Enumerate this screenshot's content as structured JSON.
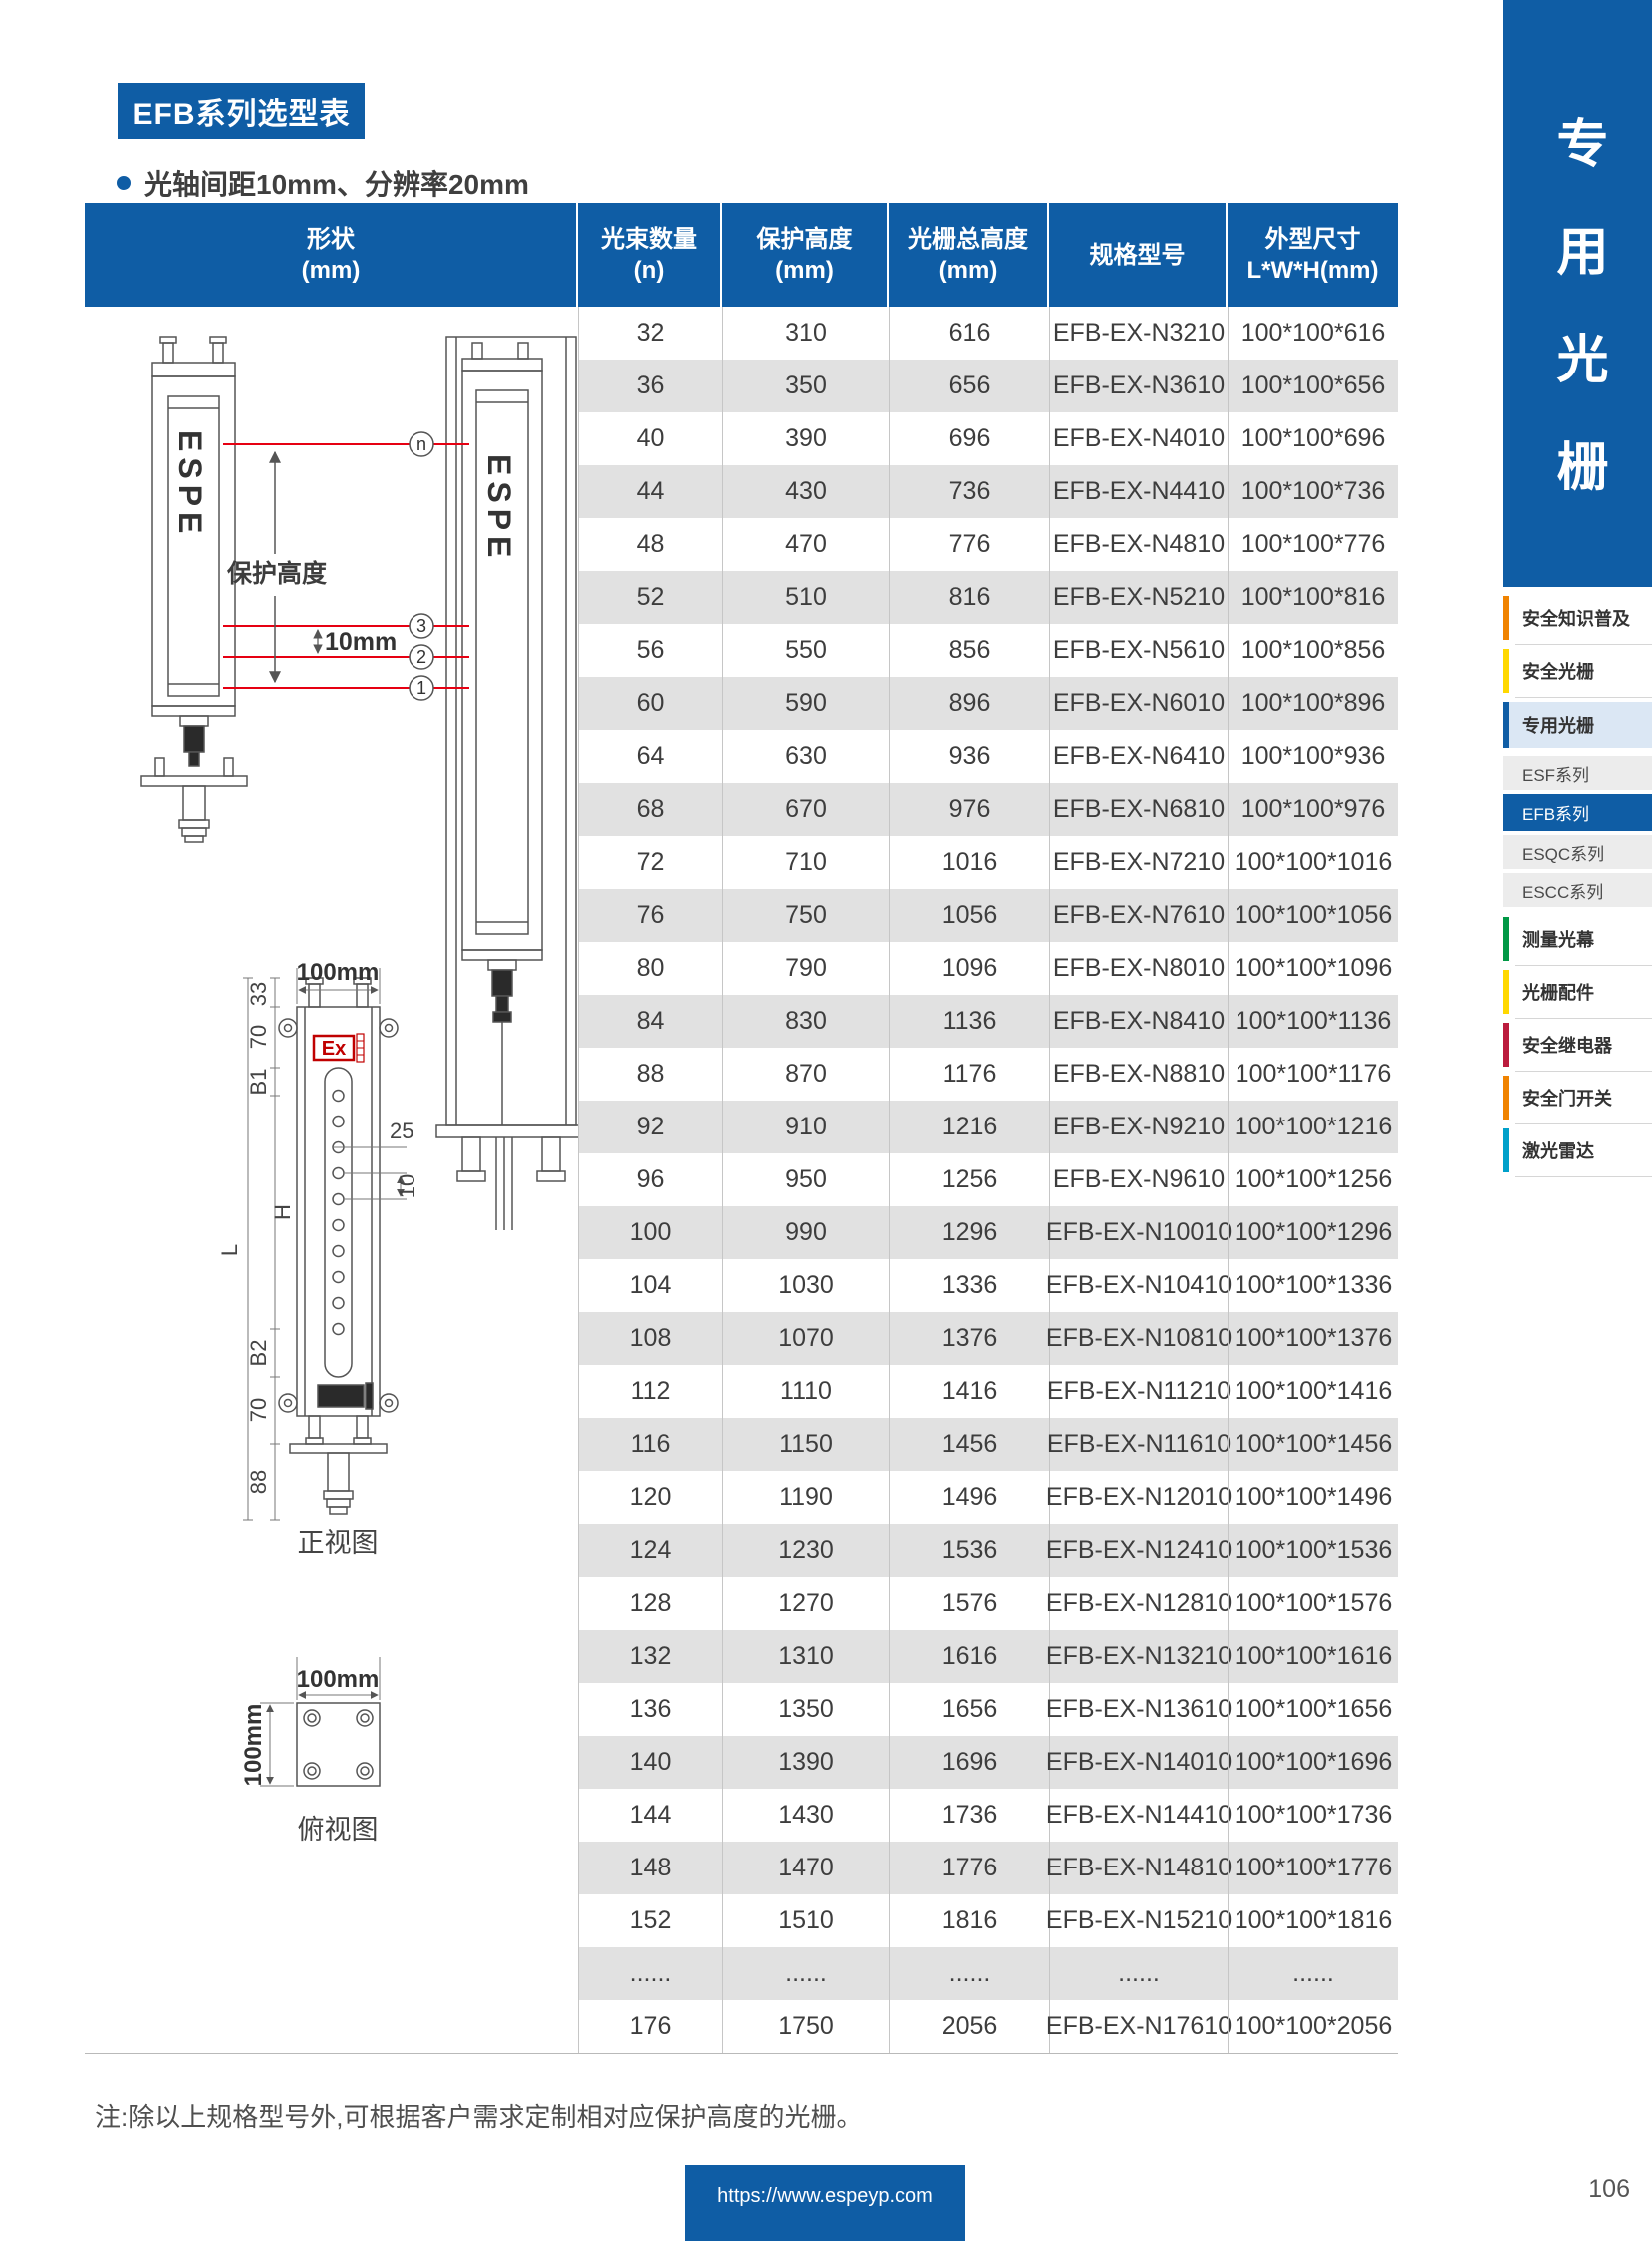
{
  "page": {
    "title": "EFB系列选型表",
    "subtitle_bullet": "光轴间距10mm、分辨率20mm",
    "note": "注:除以上规格型号外,可根据客户需求定制相对应保护高度的光栅。",
    "footer_url": "https://www.espeyp.com",
    "page_number": "106"
  },
  "colors": {
    "primary_blue": "#0f5da5",
    "row_stripe": "#e1e1e1",
    "beam_red": "#e60012"
  },
  "table": {
    "headers": [
      {
        "line1": "形状",
        "line2": "(mm)"
      },
      {
        "line1": "光束数量",
        "line2": "(n)"
      },
      {
        "line1": "保护高度",
        "line2": "(mm)"
      },
      {
        "line1": "光栅总高度",
        "line2": "(mm)"
      },
      {
        "line1": "规格型号",
        "line2": ""
      },
      {
        "line1": "外型尺寸",
        "line2": "L*W*H(mm)"
      }
    ],
    "rows": [
      [
        "32",
        "310",
        "616",
        "EFB-EX-N3210",
        "100*100*616"
      ],
      [
        "36",
        "350",
        "656",
        "EFB-EX-N3610",
        "100*100*656"
      ],
      [
        "40",
        "390",
        "696",
        "EFB-EX-N4010",
        "100*100*696"
      ],
      [
        "44",
        "430",
        "736",
        "EFB-EX-N4410",
        "100*100*736"
      ],
      [
        "48",
        "470",
        "776",
        "EFB-EX-N4810",
        "100*100*776"
      ],
      [
        "52",
        "510",
        "816",
        "EFB-EX-N5210",
        "100*100*816"
      ],
      [
        "56",
        "550",
        "856",
        "EFB-EX-N5610",
        "100*100*856"
      ],
      [
        "60",
        "590",
        "896",
        "EFB-EX-N6010",
        "100*100*896"
      ],
      [
        "64",
        "630",
        "936",
        "EFB-EX-N6410",
        "100*100*936"
      ],
      [
        "68",
        "670",
        "976",
        "EFB-EX-N6810",
        "100*100*976"
      ],
      [
        "72",
        "710",
        "1016",
        "EFB-EX-N7210",
        "100*100*1016"
      ],
      [
        "76",
        "750",
        "1056",
        "EFB-EX-N7610",
        "100*100*1056"
      ],
      [
        "80",
        "790",
        "1096",
        "EFB-EX-N8010",
        "100*100*1096"
      ],
      [
        "84",
        "830",
        "1136",
        "EFB-EX-N8410",
        "100*100*1136"
      ],
      [
        "88",
        "870",
        "1176",
        "EFB-EX-N8810",
        "100*100*1176"
      ],
      [
        "92",
        "910",
        "1216",
        "EFB-EX-N9210",
        "100*100*1216"
      ],
      [
        "96",
        "950",
        "1256",
        "EFB-EX-N9610",
        "100*100*1256"
      ],
      [
        "100",
        "990",
        "1296",
        "EFB-EX-N10010",
        "100*100*1296"
      ],
      [
        "104",
        "1030",
        "1336",
        "EFB-EX-N10410",
        "100*100*1336"
      ],
      [
        "108",
        "1070",
        "1376",
        "EFB-EX-N10810",
        "100*100*1376"
      ],
      [
        "112",
        "1110",
        "1416",
        "EFB-EX-N11210",
        "100*100*1416"
      ],
      [
        "116",
        "1150",
        "1456",
        "EFB-EX-N11610",
        "100*100*1456"
      ],
      [
        "120",
        "1190",
        "1496",
        "EFB-EX-N12010",
        "100*100*1496"
      ],
      [
        "124",
        "1230",
        "1536",
        "EFB-EX-N12410",
        "100*100*1536"
      ],
      [
        "128",
        "1270",
        "1576",
        "EFB-EX-N12810",
        "100*100*1576"
      ],
      [
        "132",
        "1310",
        "1616",
        "EFB-EX-N13210",
        "100*100*1616"
      ],
      [
        "136",
        "1350",
        "1656",
        "EFB-EX-N13610",
        "100*100*1656"
      ],
      [
        "140",
        "1390",
        "1696",
        "EFB-EX-N14010",
        "100*100*1696"
      ],
      [
        "144",
        "1430",
        "1736",
        "EFB-EX-N14410",
        "100*100*1736"
      ],
      [
        "148",
        "1470",
        "1776",
        "EFB-EX-N14810",
        "100*100*1776"
      ],
      [
        "152",
        "1510",
        "1816",
        "EFB-EX-N15210",
        "100*100*1816"
      ],
      [
        "......",
        "......",
        "......",
        "......",
        "......"
      ],
      [
        "176",
        "1750",
        "2056",
        "EFB-EX-N17610",
        "100*100*2056"
      ]
    ]
  },
  "sidebar": {
    "banner_title": "专用光栅",
    "items": [
      {
        "label": "安全知识普及",
        "type": "main",
        "accent": "#f08300"
      },
      {
        "label": "安全光栅",
        "type": "main",
        "accent": "#ffd800"
      },
      {
        "label": "专用光栅",
        "type": "main-active",
        "accent": "#0f5da5"
      },
      {
        "label": "ESF系列",
        "type": "sub"
      },
      {
        "label": "EFB系列",
        "type": "sub-active"
      },
      {
        "label": "ESQC系列",
        "type": "sub"
      },
      {
        "label": "ESCC系列",
        "type": "sub"
      },
      {
        "label": "测量光幕",
        "type": "main",
        "accent": "#009845"
      },
      {
        "label": "光栅配件",
        "type": "main",
        "accent": "#ffd800"
      },
      {
        "label": "安全继电器",
        "type": "main",
        "accent": "#bb1b3d"
      },
      {
        "label": "安全门开关",
        "type": "main",
        "accent": "#f08300"
      },
      {
        "label": "激光雷达",
        "type": "main",
        "accent": "#00a0ca"
      }
    ]
  },
  "diagram": {
    "brand": "ESPE",
    "protection_height_label": "保护高度",
    "pitch_label": "10mm",
    "beam_labels": [
      "n",
      "3",
      "2",
      "1"
    ],
    "front_view": {
      "caption": "正视图",
      "width_label": "100mm",
      "ex_label": "Ex",
      "dims": [
        "33",
        "70",
        "B1",
        "H",
        "B2",
        "70",
        "88",
        "L"
      ],
      "dims_right": [
        "25",
        "10"
      ]
    },
    "top_view": {
      "caption": "俯视图",
      "width_label": "100mm",
      "height_label": "100mm"
    }
  }
}
